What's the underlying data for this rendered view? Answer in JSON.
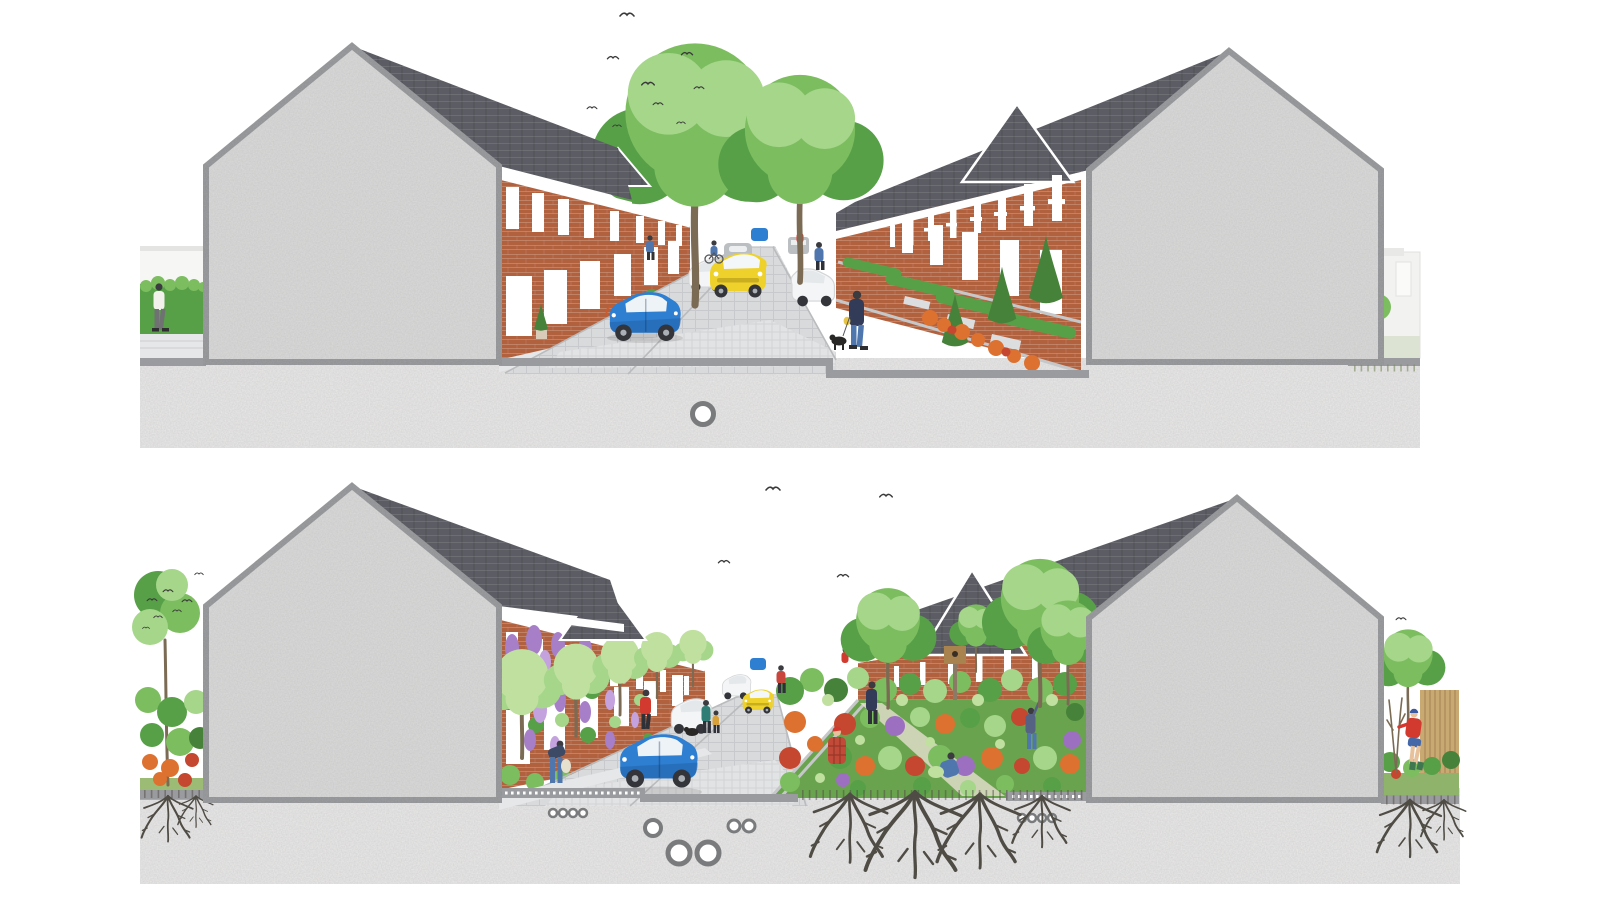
{
  "illustration": {
    "title": "Two stacked street cross-sections through a brick terraced street: upper panel shows the existing paved street, lower panel shows the same street greened with wisteria facades, street trees, a community rain garden and visible tree roots below ground",
    "panels": [
      {
        "id": "upper",
        "label": "Existing street section: grey sectioned gable walls either side, brick terraces, block-paved road with parked cars, two street trees, small front gardens on the right",
        "left_vignette": "pedestrian walking past a clipped hedge",
        "right_vignette": "rear yard with shrub and garage wall",
        "vehicles": [
          "blue hatchback",
          "white car",
          "yellow car",
          "grey car",
          "small blue car",
          "white SUV",
          "grey van"
        ],
        "people": [
          "pedestrian on pavement",
          "cyclist",
          "person in blue by front gardens",
          "person in red",
          "man walking a dog"
        ],
        "underground": [
          "single service pipe"
        ]
      },
      {
        "id": "lower",
        "label": "Greened street section: same gables, wisteria-covered terraces, avenue of young street trees, community rain garden replacing half the carriageway, roots and permeable layers below ground",
        "left_vignette": "flowering front garden with a flock of small birds",
        "right_vignette": "back garden with timber fence, young tree and a gardener pruning",
        "vehicles": [
          "blue hatchback",
          "white car",
          "yellow car",
          "small grey car",
          "small blue car"
        ],
        "people": [
          "person watering plants",
          "person in red walking",
          "adult with child and dog",
          "person crossing the road",
          "gardener in plaid shirt",
          "kneeling gardener",
          "gardener reaching into tree",
          "gardener pruning in back garden"
        ],
        "garden": "community rain garden with flowers, vegetables, raised bed edge and a bird house",
        "underground": [
          "permeable sub-base dotted layer",
          "service pipes of varied sizes",
          "tree roots"
        ]
      }
    ]
  },
  "colors": {
    "pageBg": "#ffffff",
    "wall": "#dbdbda",
    "wallEdge": "#8e9092",
    "roof": "#5c5d64",
    "fascia": "#ffffff",
    "brick": "#b2613e",
    "window": "#ffffff",
    "road": "#d9dadc",
    "pave": "#e6e7e8",
    "paveBand": "#e2e3e4",
    "cut": "#9a9b9e",
    "ground": "#ebeae9",
    "green1": "#7cbd5f",
    "green2": "#57a048",
    "green3": "#a5d68a",
    "greenLight": "#c0e0a0",
    "conifer": "#47823a",
    "trunk": "#7b6b54",
    "wisteria": "#a67fc8",
    "wisteriaLight": "#c4a2de",
    "flowerOrange": "#dd7130",
    "flowerRed": "#c5472f",
    "flowerPurple": "#9d6fc0",
    "carBlue": "#2e7fd2",
    "carBlueDark": "#2563a8",
    "carYellow": "#eed22b",
    "carWhite": "#f4f5f6",
    "carGray": "#bcbfc2",
    "tire": "#33353a",
    "fence": "#c9a972",
    "root": "#4f4c45",
    "bird": "#3a3a3a",
    "skin": "#e6c19b",
    "navy": "#323b57",
    "denim": "#5077ad",
    "redShirt": "#d23a30",
    "teal": "#2f7d74",
    "grassLight": "#dde3d2",
    "grassGreen": "#9cbb74",
    "soil": "#6aa34e",
    "birdhouse": "#a9834f"
  }
}
